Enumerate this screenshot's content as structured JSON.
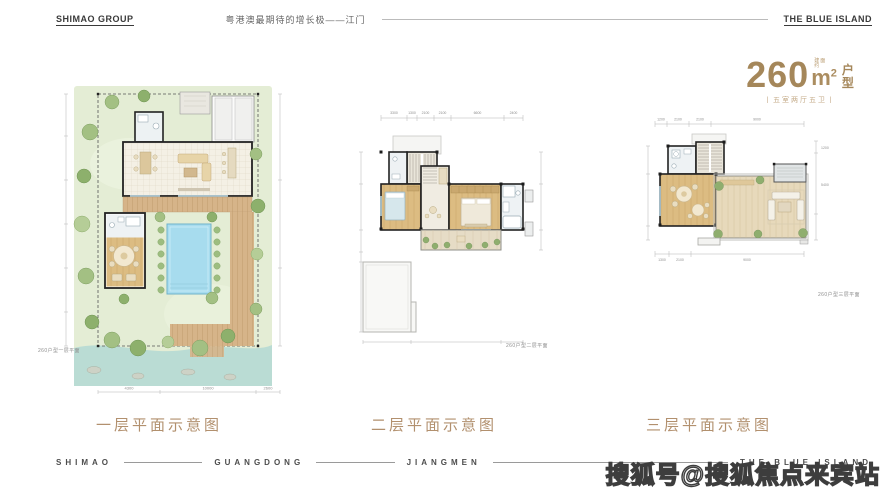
{
  "header": {
    "logo": "SHIMAO GROUP",
    "tagline": "粤港澳最期待的增长极——江门",
    "brand": "THE BLUE ISLAND"
  },
  "unit": {
    "number": "260",
    "unit": "m",
    "sup": "2",
    "prefix1": "建面",
    "prefix2": "约",
    "type1": "户",
    "type2": "型",
    "spec": "丨五室两厅五卫丨"
  },
  "plans": [
    {
      "caption": "一层平面示意图",
      "mini": "260户型一层平面",
      "dims_bottom": [
        "4300",
        "10000",
        "2600"
      ]
    },
    {
      "caption": "二层平面示意图",
      "mini": "260户型二层平面",
      "dims_top": [
        "3300",
        "1300",
        "2100",
        "2100",
        "6600",
        "2400"
      ]
    },
    {
      "caption": "三层平面示意图",
      "mini": "260户型三层平面",
      "dims_top": [
        "1200",
        "2100",
        "2100",
        "9000"
      ],
      "dims_bottom": [
        "1300",
        "2100",
        "9000"
      ],
      "dims_right": [
        "1200",
        "5400"
      ]
    }
  ],
  "footer": {
    "w1": "SHIMAO",
    "w2": "GUANGDONG",
    "w3": "JIANGMEN",
    "w4": "THE BLUE ISLAND"
  },
  "watermark": {
    "text": "搜狐号@搜狐焦点来宾站"
  },
  "colors": {
    "accent_gold": "#a5875a",
    "caption_gold": "#b2906e",
    "lawn": "#e4edd5",
    "stream": "#badcd4",
    "pool": "#a7dcee",
    "wood_floor": "#d9b87c",
    "deck": "#d6b489",
    "wall": "#222222"
  }
}
